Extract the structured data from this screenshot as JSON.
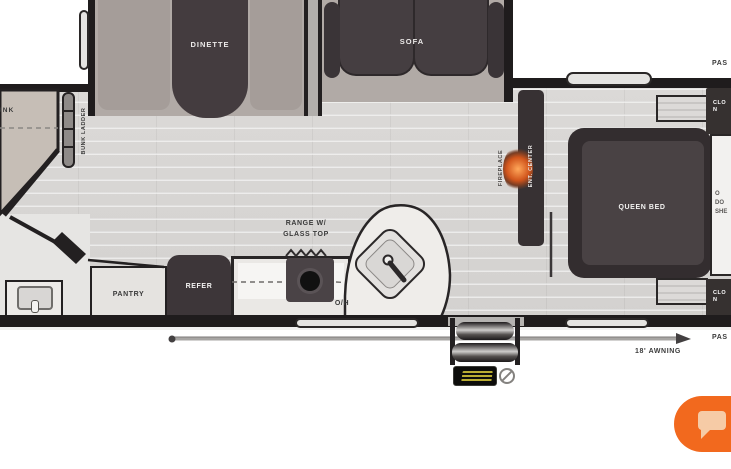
{
  "page": {
    "type": "rv-floor-plan",
    "labels": {
      "dinette": "DINETTE",
      "sofa": "SOFA",
      "bunk": "BUNK",
      "bunk_ladder": "BUNK LADDER",
      "fireplace": "FIREPLACE",
      "ent_center": "ENT. CENTER",
      "queen_bed": "QUEEN BED",
      "range_line1": "RANGE W/",
      "range_line2": "GLASS TOP",
      "pantry": "PANTRY",
      "refer": "REFER",
      "overhead": "O/H",
      "awning": "18' AWNING",
      "pass_top": "PAS",
      "pass_bottom": "PAS",
      "closet_top_line1": "CLO",
      "closet_top_line2": "N",
      "closet_bottom_line1": "CLO",
      "closet_bottom_line2": "N",
      "wardrobe_line1": "O",
      "wardrobe_line2": "DO",
      "wardrobe_line3": "SHE"
    },
    "icons": {
      "chat": "chat-bubble-icon",
      "step_badge": "solid-step-logo",
      "step_symbol": "circle-slash-icon",
      "fireplace_flame": "flame-icon"
    },
    "colors": {
      "accent_orange": "#F2691E",
      "wall_dark": "#1F1C1D",
      "furniture_dark": "#453E41",
      "floor_gray": "#D8D6D4",
      "bunk_beige": "#C6BEB6",
      "flame_orange": "#D1551C",
      "badge_yellow": "#D9C93A"
    }
  }
}
